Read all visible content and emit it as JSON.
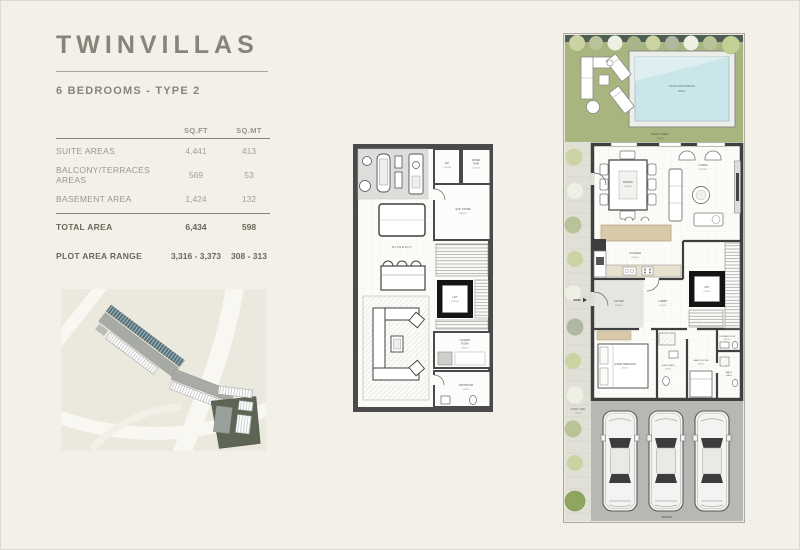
{
  "page": {
    "title": "TWINVILLAS",
    "subtitle": "6 BEDROOMS - TYPE 2"
  },
  "area_table": {
    "col_headers": [
      "SQ.FT",
      "SQ.MT"
    ],
    "rows": [
      {
        "label": "SUITE AREAS",
        "sqft": "4,441",
        "sqmt": "413"
      },
      {
        "label": "BALCONY/TERRACES AREAS",
        "sqft": "569",
        "sqmt": "53"
      },
      {
        "label": "BASEMENT AREA",
        "sqft": "1,424",
        "sqmt": "132"
      },
      {
        "label": "TOTAL AREA",
        "sqft": "6,434",
        "sqmt": "598"
      },
      {
        "label": "PLOT AREA RANGE",
        "sqft": "3,316 - 3,373",
        "sqmt": "308 - 313"
      }
    ]
  },
  "basement_plan": {
    "labels": {
      "hk": "HK",
      "hk_dim": "1.4X1.8",
      "wt_l1": "WATER",
      "wt_l2": "TANK",
      "wt_dim": "1.4X1.8",
      "sup_store": "SUP. STORE",
      "sup_store_dim": "3.4X3.7",
      "basement": "BASEMENT",
      "lift": "LIFT",
      "lift_dim": "2.0X1.8",
      "laundry_l1": "LAUNDRY",
      "laundry_l2": "ROOM",
      "laundry_dim": "1.8X1.7",
      "bathroom": "BATHROOM",
      "bathroom_dim": "1.5X3.1"
    }
  },
  "ground_plan": {
    "labels": {
      "pool_l1": "POOL PROVISION",
      "pool_l2": "ONLY",
      "back_yard": "BACK YARD",
      "back_yard_dim": "7.4X5.7",
      "dining": "DINING",
      "dining_dim": "3.6X4.2",
      "living": "LIVING",
      "living_dim": "5.5X5.8",
      "kitchen": "KITCHEN",
      "kitchen_dim": "3.4X4.1",
      "foyer": "FOYER",
      "foyer_dim": "2.5X2.4",
      "lobby": "LOBBY",
      "lobby_dim": "2.5X2.5",
      "main": "MAIN",
      "lift": "LIFT",
      "lift_dim": "2.0X1.8",
      "powder": "POWDER ROOM",
      "powder_dim": "2.5X1.5",
      "guest_bedroom": "GUEST BEDROOM",
      "guest_bedroom_dim": "3.1X4.7",
      "guest_bath": "GUEST BATH",
      "guest_bath_dim": "1.6X3.1",
      "maids_room": "MAID'S ROOM",
      "maids_room_dim": "3.0X2.4",
      "maids_bath_l1": "MAID'S",
      "maids_bath_l2": "BATH",
      "front_yard": "FRONT YARD",
      "front_yard_dim": "7.4X6.0",
      "parking": "PARKING"
    }
  },
  "colors": {
    "page_bg": "#f2f0e9",
    "accent_text": "#8a8478",
    "wall": "#3f3f3f",
    "lawn": "#a9b57e",
    "pool_water": "#c9e6ea",
    "kitchen_island": "#d8c9a8",
    "driveway": "#b7b7b4"
  }
}
